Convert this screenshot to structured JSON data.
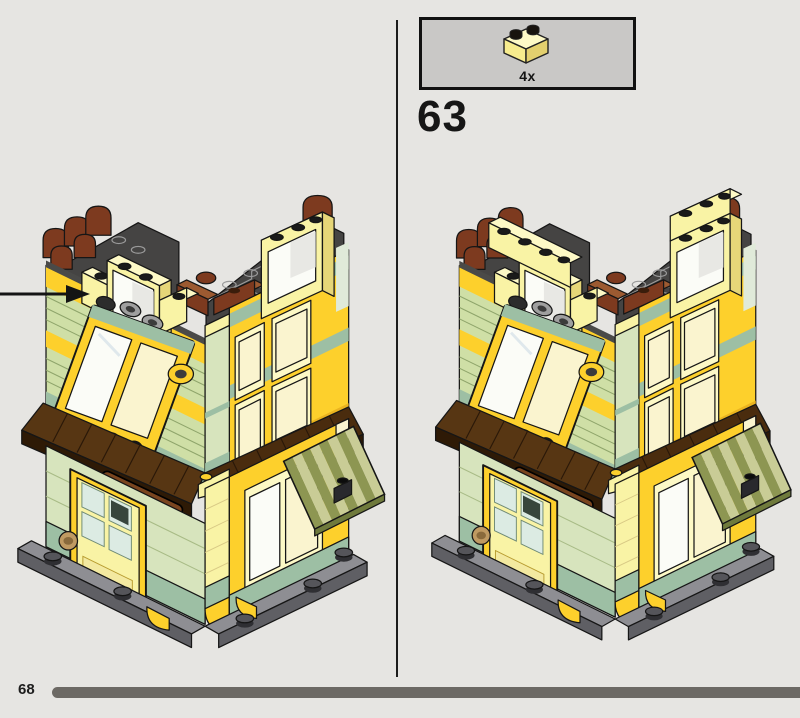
{
  "step": {
    "number": "63"
  },
  "callout": {
    "quantity": "4x",
    "part_icon": "yellow-1x2-brick-icon",
    "part_color": "#F9F3A5"
  },
  "footer": {
    "page_number": "68"
  },
  "palette": {
    "background": "#E6E5E2",
    "divider": "#1C1C1C",
    "callout_bg": "#C9C8C6",
    "brick_yellow": "#FDD02C",
    "pale_yellow": "#F9F3A5",
    "sand_green": "#CFDFA6",
    "sage": "#9DBFA4",
    "roof_brown": "#573613",
    "reddish_brown": "#7D3A1F",
    "gable_gray": "#454443",
    "awning_olive": "#8D9652",
    "base_gray": "#8E8E93",
    "progress_bar": "#6C6964"
  },
  "scene": {
    "left_model": "corner-building-view-with-placement-arrow",
    "right_model": "corner-building-view-after-adding-four-bricks"
  }
}
